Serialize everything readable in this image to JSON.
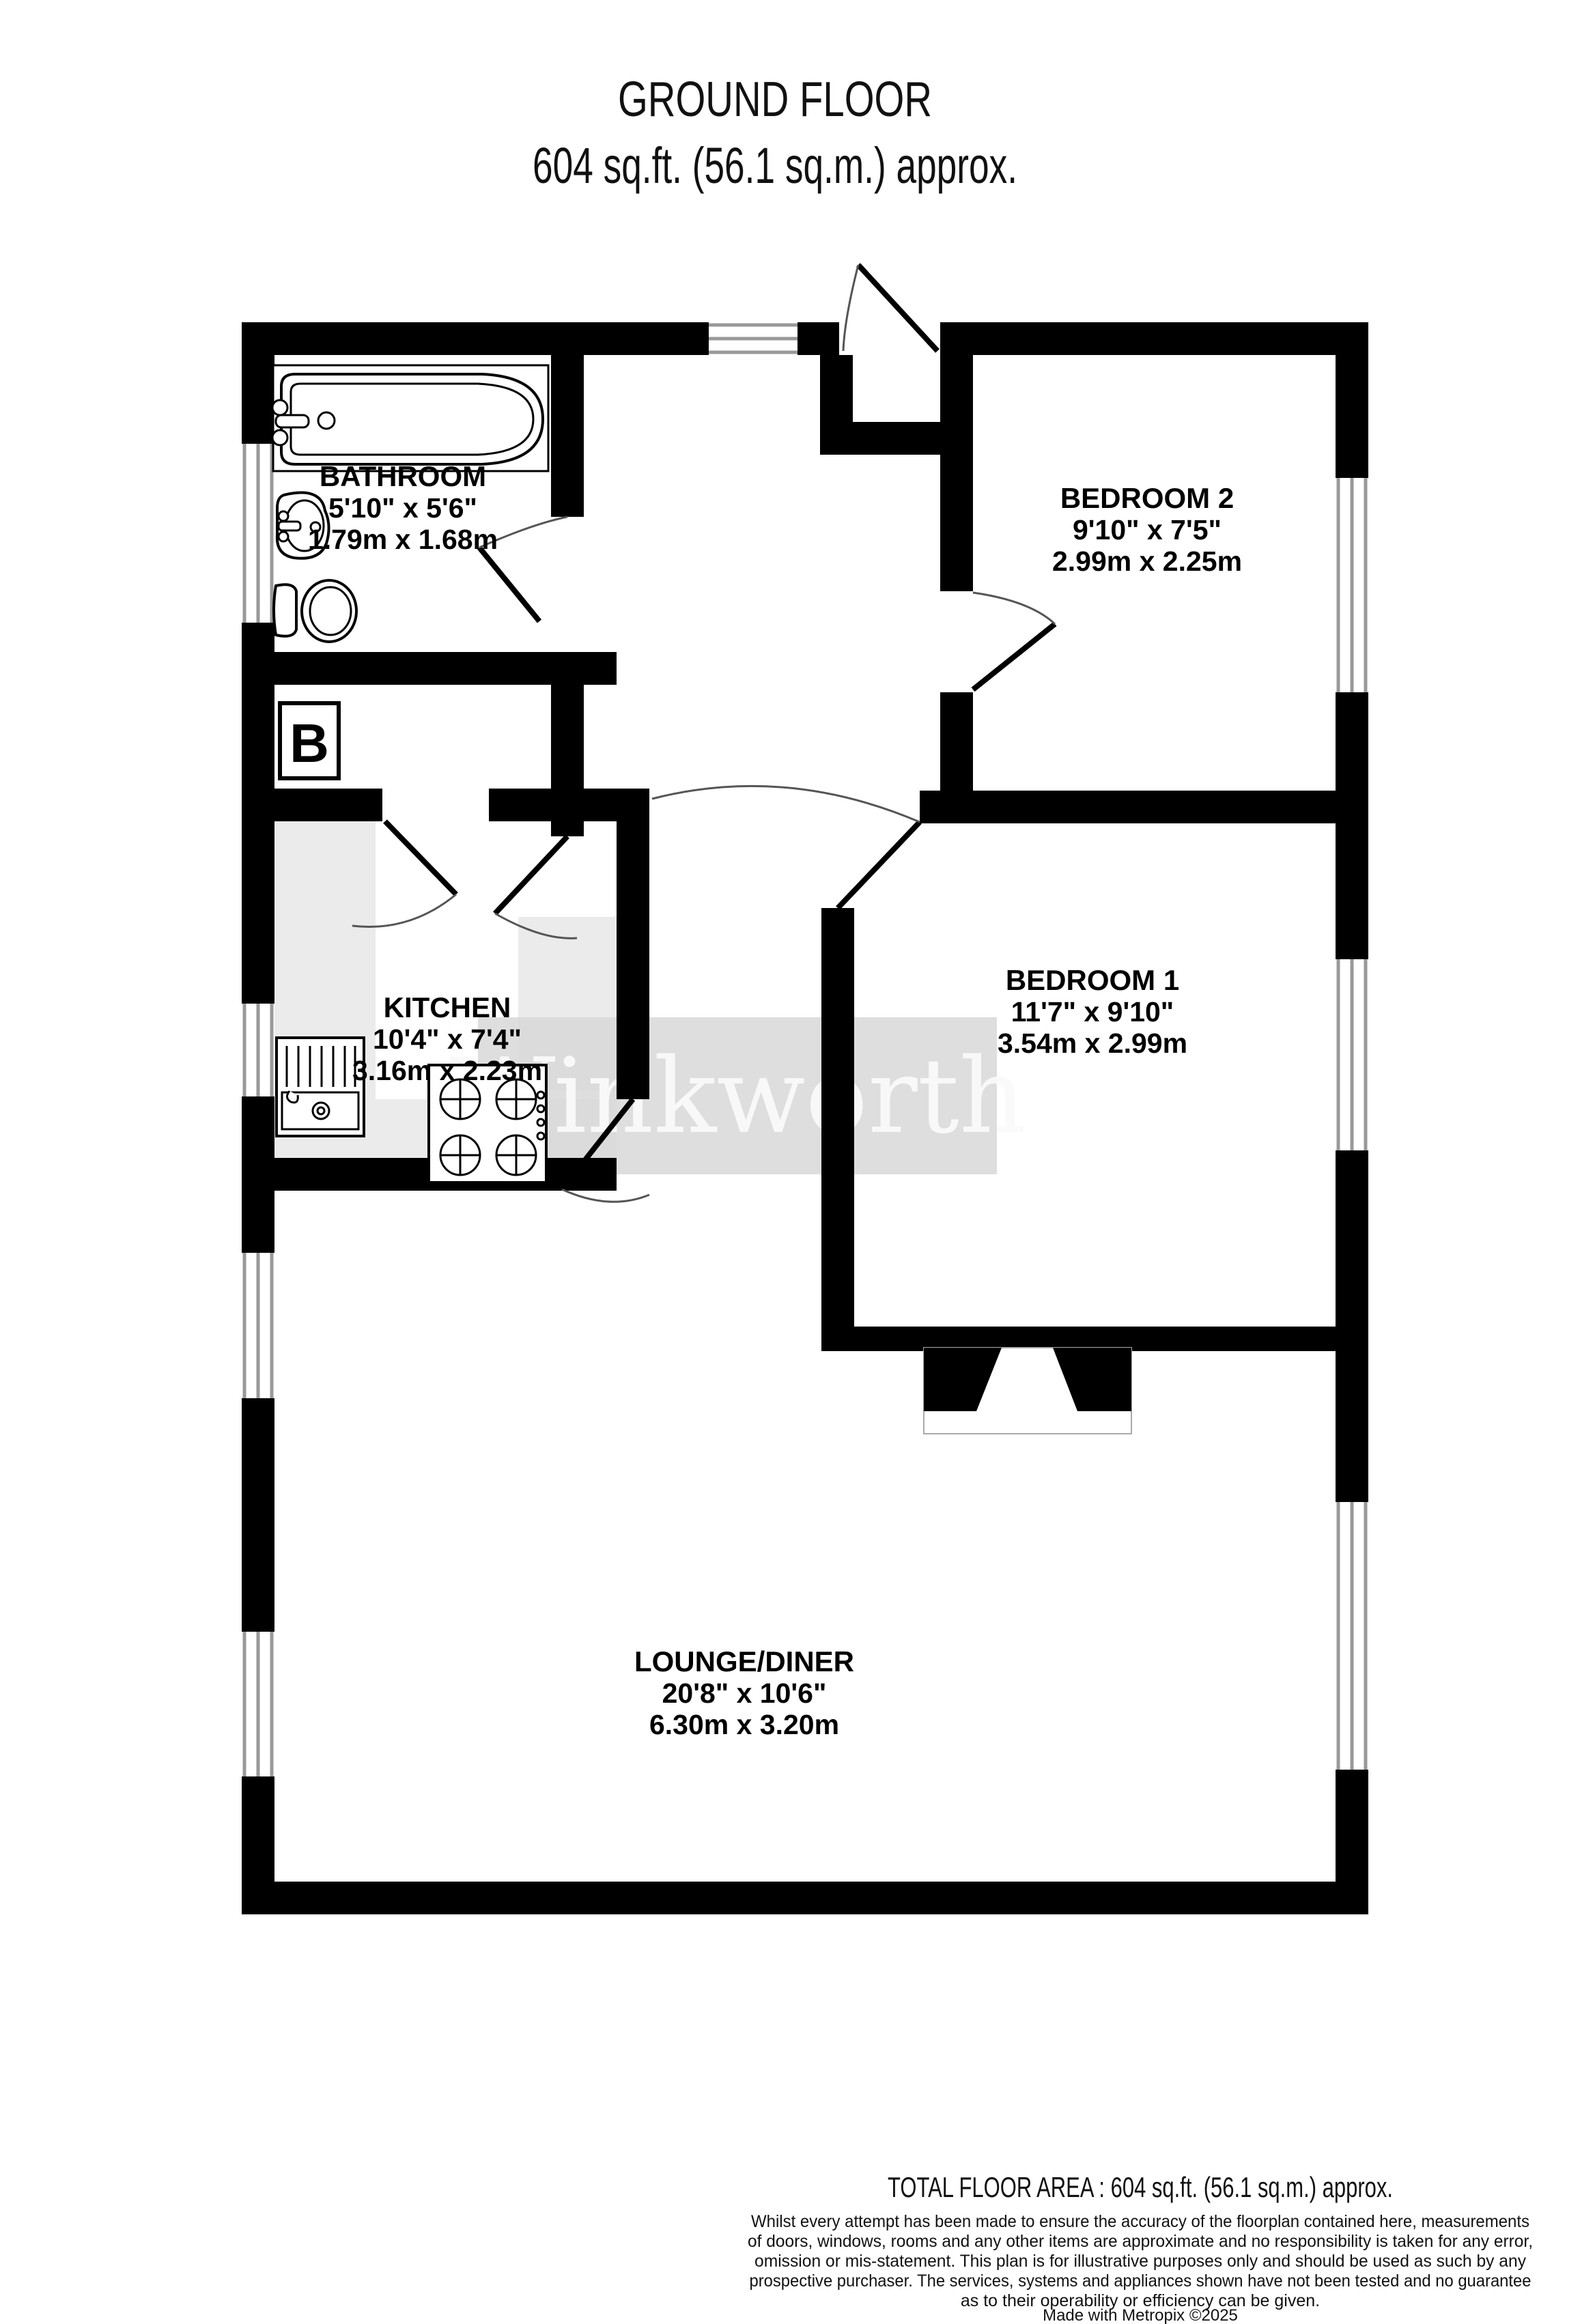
{
  "title": {
    "line1": "GROUND FLOOR",
    "line2": "604 sq.ft. (56.1 sq.m.) approx."
  },
  "rooms": {
    "bathroom": {
      "name": "BATHROOM",
      "imperial": "5'10\"  x 5'6\"",
      "metric": "1.79m  x 1.68m"
    },
    "bedroom2": {
      "name": "BEDROOM 2",
      "imperial": "9'10\"  x 7'5\"",
      "metric": "2.99m  x 2.25m"
    },
    "kitchen": {
      "name": "KITCHEN",
      "imperial": "10'4\"  x 7'4\"",
      "metric": "3.16m  x 2.23m"
    },
    "bedroom1": {
      "name": "BEDROOM 1",
      "imperial": "11'7\"  x 9'10\"",
      "metric": "3.54m  x 2.99m"
    },
    "lounge": {
      "name": "LOUNGE/DINER",
      "imperial": "20'8\"  x 10'6\"",
      "metric": "6.30m  x 3.20m"
    }
  },
  "annotations": {
    "boiler": "B"
  },
  "watermark": {
    "text": "Winkworth"
  },
  "footer": {
    "total": "TOTAL FLOOR AREA : 604 sq.ft. (56.1 sq.m.) approx.",
    "disclaimer_lines": [
      "Whilst every attempt has been made to ensure the accuracy of the floorplan contained here, measurements",
      "of doors, windows, rooms and any other items are approximate and no responsibility is taken for any error,",
      "omission or mis-statement. This plan is for illustrative purposes only and should be used as such by any",
      "prospective purchaser. The services, systems and appliances shown have not been tested and no guarantee",
      "as to their operability or efficiency can be given."
    ],
    "credit": "Made with Metropix ©2025"
  },
  "colors": {
    "wall": "#000000",
    "window_line": "#999999",
    "door_arc": "#555555",
    "counter": "#ebebeb",
    "watermark_box": "#d7d7d7"
  }
}
